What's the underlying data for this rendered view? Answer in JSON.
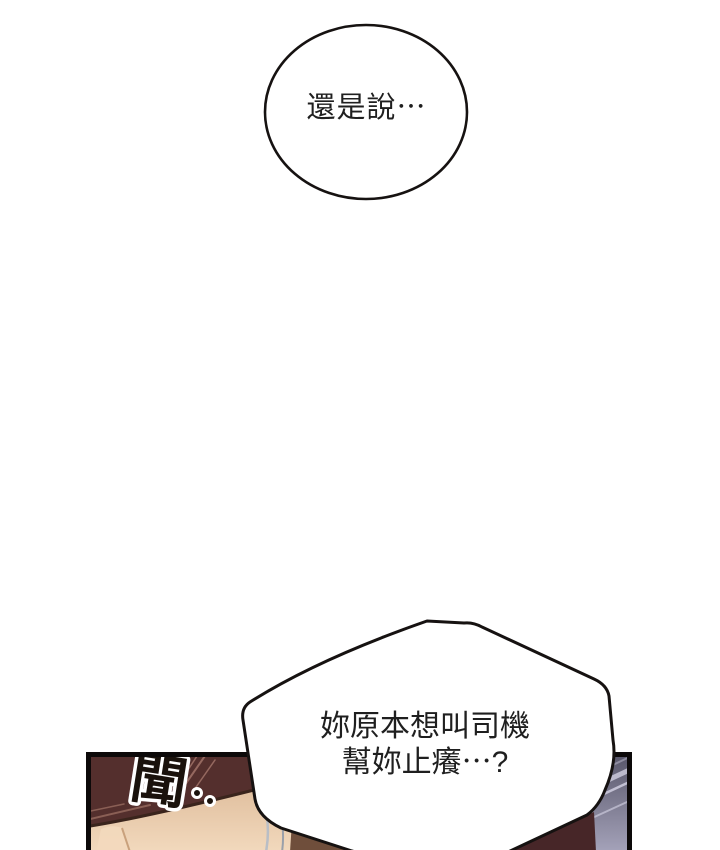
{
  "speech_bubbles": {
    "top": {
      "text": "還是說⋯"
    },
    "bottom": {
      "line1": "妳原本想叫司機",
      "line2": "幫妳止癢⋯?"
    }
  },
  "panel": {
    "sfx": "聞",
    "sfx_dots": "‥"
  },
  "colors": {
    "panel": "#542f2d",
    "panel-border": "#0c0909",
    "skin-light": "#f2d9bd",
    "skin-dark": "#e0bf9e",
    "skin-outline": "#3a241c",
    "hair": "#6f4e3b",
    "hair-dark": "#472628",
    "window-top": "#565468",
    "window-bottom": "#a3a1b8",
    "streak": "#cbc9db",
    "bubble-stroke": "#161211",
    "text": "#1f1f1f"
  }
}
